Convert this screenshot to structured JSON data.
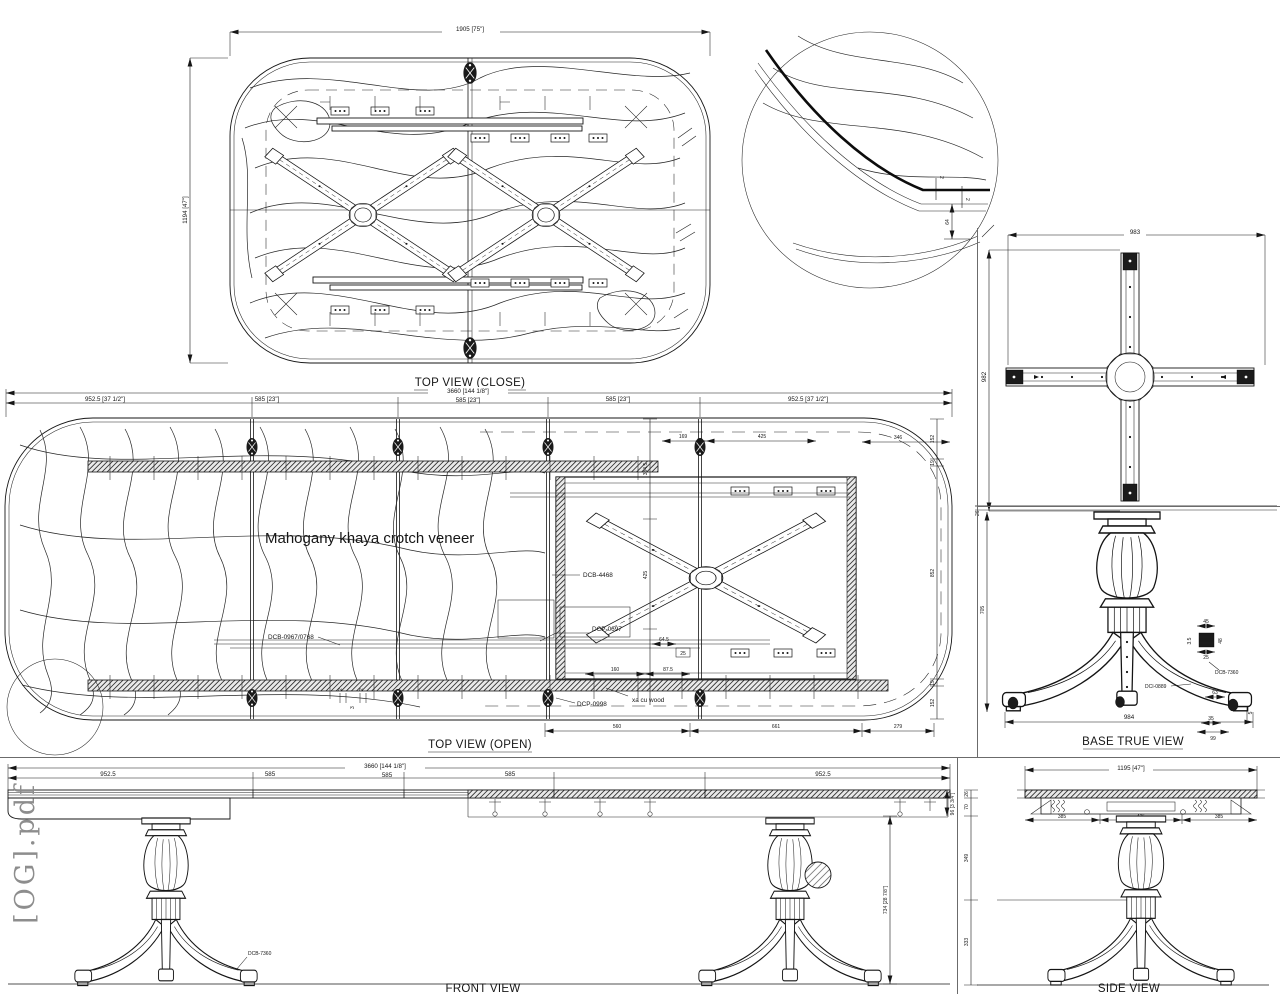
{
  "watermark": "[OG].pdf",
  "top_view_close": {
    "title": "TOP VIEW (CLOSE)",
    "dim_width": "1905 [75\"]",
    "dim_height": "1194 [47\"]"
  },
  "detail": {
    "dim_edge_a": "2",
    "dim_edge_b": "2",
    "dim_drop": "64"
  },
  "cross": {
    "dim_width": "983",
    "dim_height": "982"
  },
  "open": {
    "title": "TOP VIEW (OPEN)",
    "dim_overall": "3660 [144 1/8\"]",
    "seg1": "952.5 [37 1/2\"]",
    "seg2": "585 [23\"]",
    "seg3": "585 [23\"]",
    "seg4": "585 [23\"]",
    "seg5": "952.5 [37 1/2\"]",
    "veneer_note": "Mahogany khaya crotch veneer",
    "label_dcb0967": "DCB-0967/0768",
    "label_dcb4468": "DCB-4468",
    "label_dcp0697": "DCP-0697",
    "label_dcp0998": "DCP-0998",
    "label_wood": "xa cu wood",
    "dim_169": "169",
    "dim_425_top": "425",
    "dim_346": "346",
    "dim_152_tr": "152",
    "dim_19_tr": "19",
    "dim_852": "852",
    "dim_19_br": "19",
    "dim_152_br": "152",
    "dim_384": "384.5",
    "dim_425_left": "425",
    "dim_645": "64.5",
    "dim_25": "25",
    "dim_160": "160",
    "dim_875": "87.5",
    "dim_560": "560",
    "dim_661": "661",
    "dim_279": "279",
    "dim_2a": "2",
    "dim_3": "3",
    "dim_2b": "2"
  },
  "base": {
    "title": "BASE TRUE VIEW",
    "dim_26": "26",
    "dim_705": "705",
    "dim_984": "984",
    "det_45": "45",
    "det_35": "3.5",
    "det_48": "48",
    "det_25": "25",
    "label_dcb7360": "DCB-7360",
    "label_dci0889": "DCI-0889",
    "dim_63": "63",
    "dim_35b": "35",
    "dim_99": "99",
    "dim_5": "5"
  },
  "front": {
    "title": "FRONT VIEW",
    "dim_overall": "3660 [144 1/8\"]",
    "seg1": "952.5",
    "seg2": "585",
    "seg3": "585",
    "seg4": "585",
    "seg5": "952.5",
    "dim_height": "734 [28 7/8\"]",
    "dim_apron": "96 [3 3/4\"]",
    "label_dcb7360": "DCB-7360"
  },
  "side": {
    "title": "SIDE VIEW",
    "dim_overall": "1195 [47\"]",
    "seg1": "385",
    "seg2": "425",
    "seg3": "385",
    "dim_26": "26",
    "dim_70": "70",
    "dim_349": "349",
    "dim_333": "333"
  }
}
